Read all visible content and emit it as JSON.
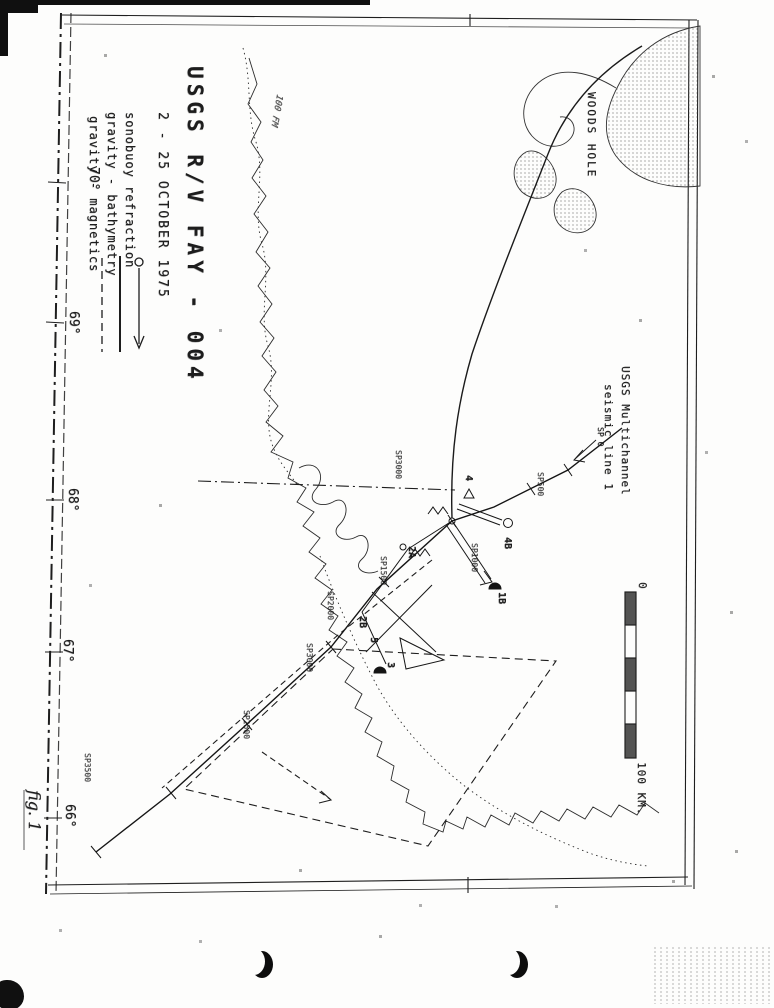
{
  "figure": {
    "caption": "fig. 1",
    "title": "USGS R/V FAY - 004",
    "dates": "2 - 25 OCTOBER 1975"
  },
  "legend": {
    "items": [
      {
        "label": "sonobuoy refraction",
        "symbol": "line-with-circle-and-arrow"
      },
      {
        "label": "gravity - bathymetry",
        "symbol": "solid-line"
      },
      {
        "label": "gravity - magnetics",
        "symbol": "dashed-line"
      }
    ]
  },
  "map": {
    "place_label": "WOODS HOLE",
    "contour_label": "100 FM",
    "multichannel_label_line1": "USGS Multichannel",
    "multichannel_label_line2": "seismic line 1",
    "multichannel_sp0": "SP 0",
    "longitude_ticks": [
      "70°",
      "69°",
      "68°",
      "67°",
      "66°"
    ],
    "shotpoint_labels": [
      "SP500",
      "SP1000",
      "SP1500",
      "SP2000",
      "SP2500",
      "SP3000",
      "SP3500"
    ],
    "track_label": "SP3000",
    "station_labels": [
      "4",
      "4B",
      "1B",
      "2A",
      "2B",
      "3",
      "5"
    ],
    "scale_start": "0",
    "scale_end": "100 KM.",
    "ink_color": "#1d1d1d"
  }
}
